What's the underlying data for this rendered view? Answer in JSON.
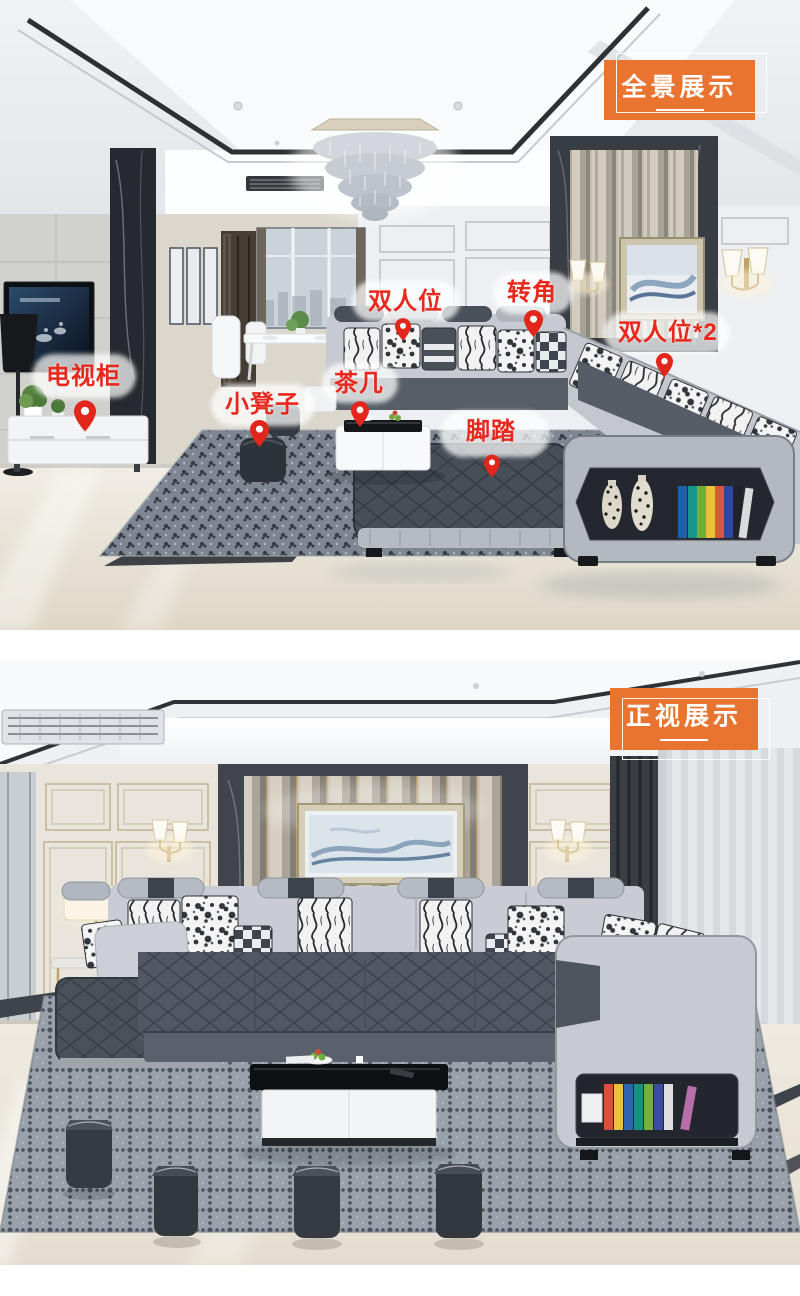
{
  "colors": {
    "accent_orange": "#E8742F",
    "label_red": "#E8281D",
    "pin_red": "#E2261B"
  },
  "panels": [
    {
      "name": "panorama-view",
      "badge": "全景展示",
      "labels": [
        {
          "id": "tv-cabinet",
          "text": "电视柜"
        },
        {
          "id": "small-stool",
          "text": "小凳子"
        },
        {
          "id": "tea-table",
          "text": "茶几"
        },
        {
          "id": "two-seater",
          "text": "双人位"
        },
        {
          "id": "corner-seat",
          "text": "转角"
        },
        {
          "id": "two-seater-x2",
          "text": "双人位*2"
        },
        {
          "id": "footstool",
          "text": "脚踏"
        }
      ]
    },
    {
      "name": "front-view",
      "badge": "正视展示",
      "labels": []
    }
  ]
}
